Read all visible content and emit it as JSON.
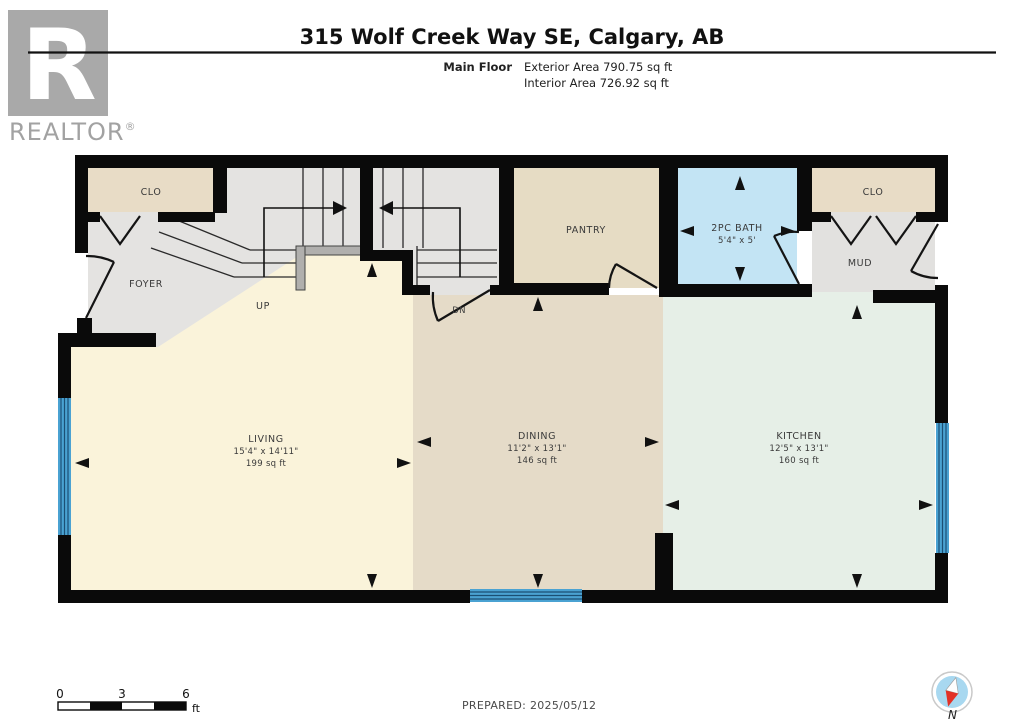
{
  "header": {
    "logo": {
      "letter": "R",
      "brand": "REALTOR",
      "registered": "®"
    },
    "title": "315 Wolf Creek Way SE, Calgary, AB",
    "floor_label": "Main Floor",
    "exterior_area": "Exterior Area 790.75 sq ft",
    "interior_area": "Interior Area 726.92 sq ft"
  },
  "rooms": {
    "clo_left": {
      "name": "CLO"
    },
    "foyer": {
      "name": "FOYER"
    },
    "stairs": {
      "up": "UP",
      "down": "DN"
    },
    "pantry": {
      "name": "PANTRY"
    },
    "bath": {
      "name": "2PC BATH",
      "dims": "5'4\" x 5'"
    },
    "clo_right": {
      "name": "CLO"
    },
    "mud": {
      "name": "MUD"
    },
    "living": {
      "name": "LIVING",
      "dims": "15'4\" x 14'11\"",
      "area": "199 sq ft"
    },
    "dining": {
      "name": "DINING",
      "dims": "11'2\" x 13'1\"",
      "area": "146 sq ft"
    },
    "kitchen": {
      "name": "KITCHEN",
      "dims": "12'5\" x 13'1\"",
      "area": "160 sq ft"
    }
  },
  "footer": {
    "scale_bar": {
      "start": "0",
      "mid": "3",
      "end": "6",
      "unit": "ft"
    },
    "prepared": "PREPARED: 2025/05/12",
    "compass": "N"
  },
  "colors": {
    "wall": "#0a0a0a",
    "living_floor": "#faf3da",
    "dining_floor": "#e5dbc8",
    "kitchen_floor": "#e6efe7",
    "bath_floor": "#c3e4f4",
    "closet_floor": "#e8dcc6",
    "hall_floor": "#e4e3e1",
    "window": "#4aa2d2",
    "compass_red": "#e23127",
    "logo_gray": "#a9a9a9"
  }
}
